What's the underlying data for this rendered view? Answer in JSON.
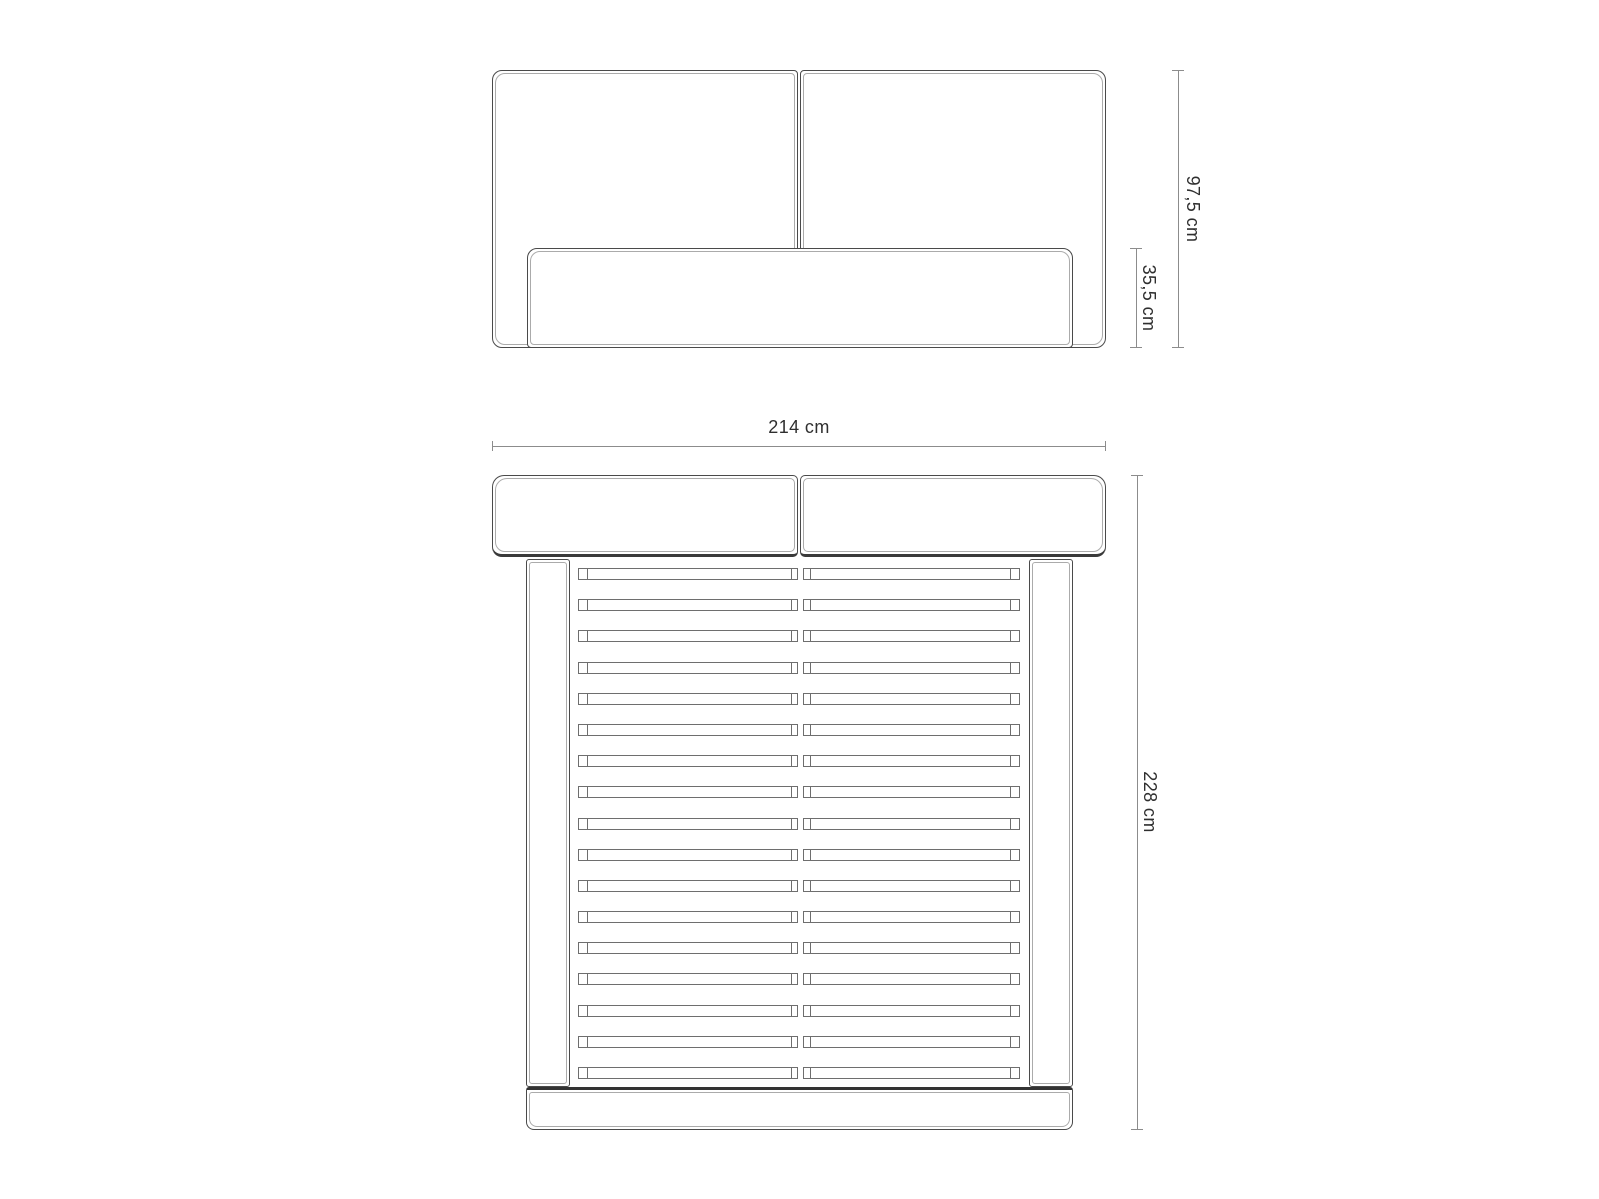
{
  "diagram": {
    "colors": {
      "background": "#ffffff",
      "outline": "#4a4a4a",
      "seam": "#ababab",
      "slat_line": "#6e6e6e",
      "dimension_line": "#8c8c8c",
      "text": "#2f2f2f"
    },
    "front_view": {
      "headboard_height_label": "97,5 cm",
      "base_height_label": "35,5 cm"
    },
    "top_view": {
      "width_label": "214 cm",
      "length_label": "228 cm",
      "slat_rows": 17
    }
  }
}
